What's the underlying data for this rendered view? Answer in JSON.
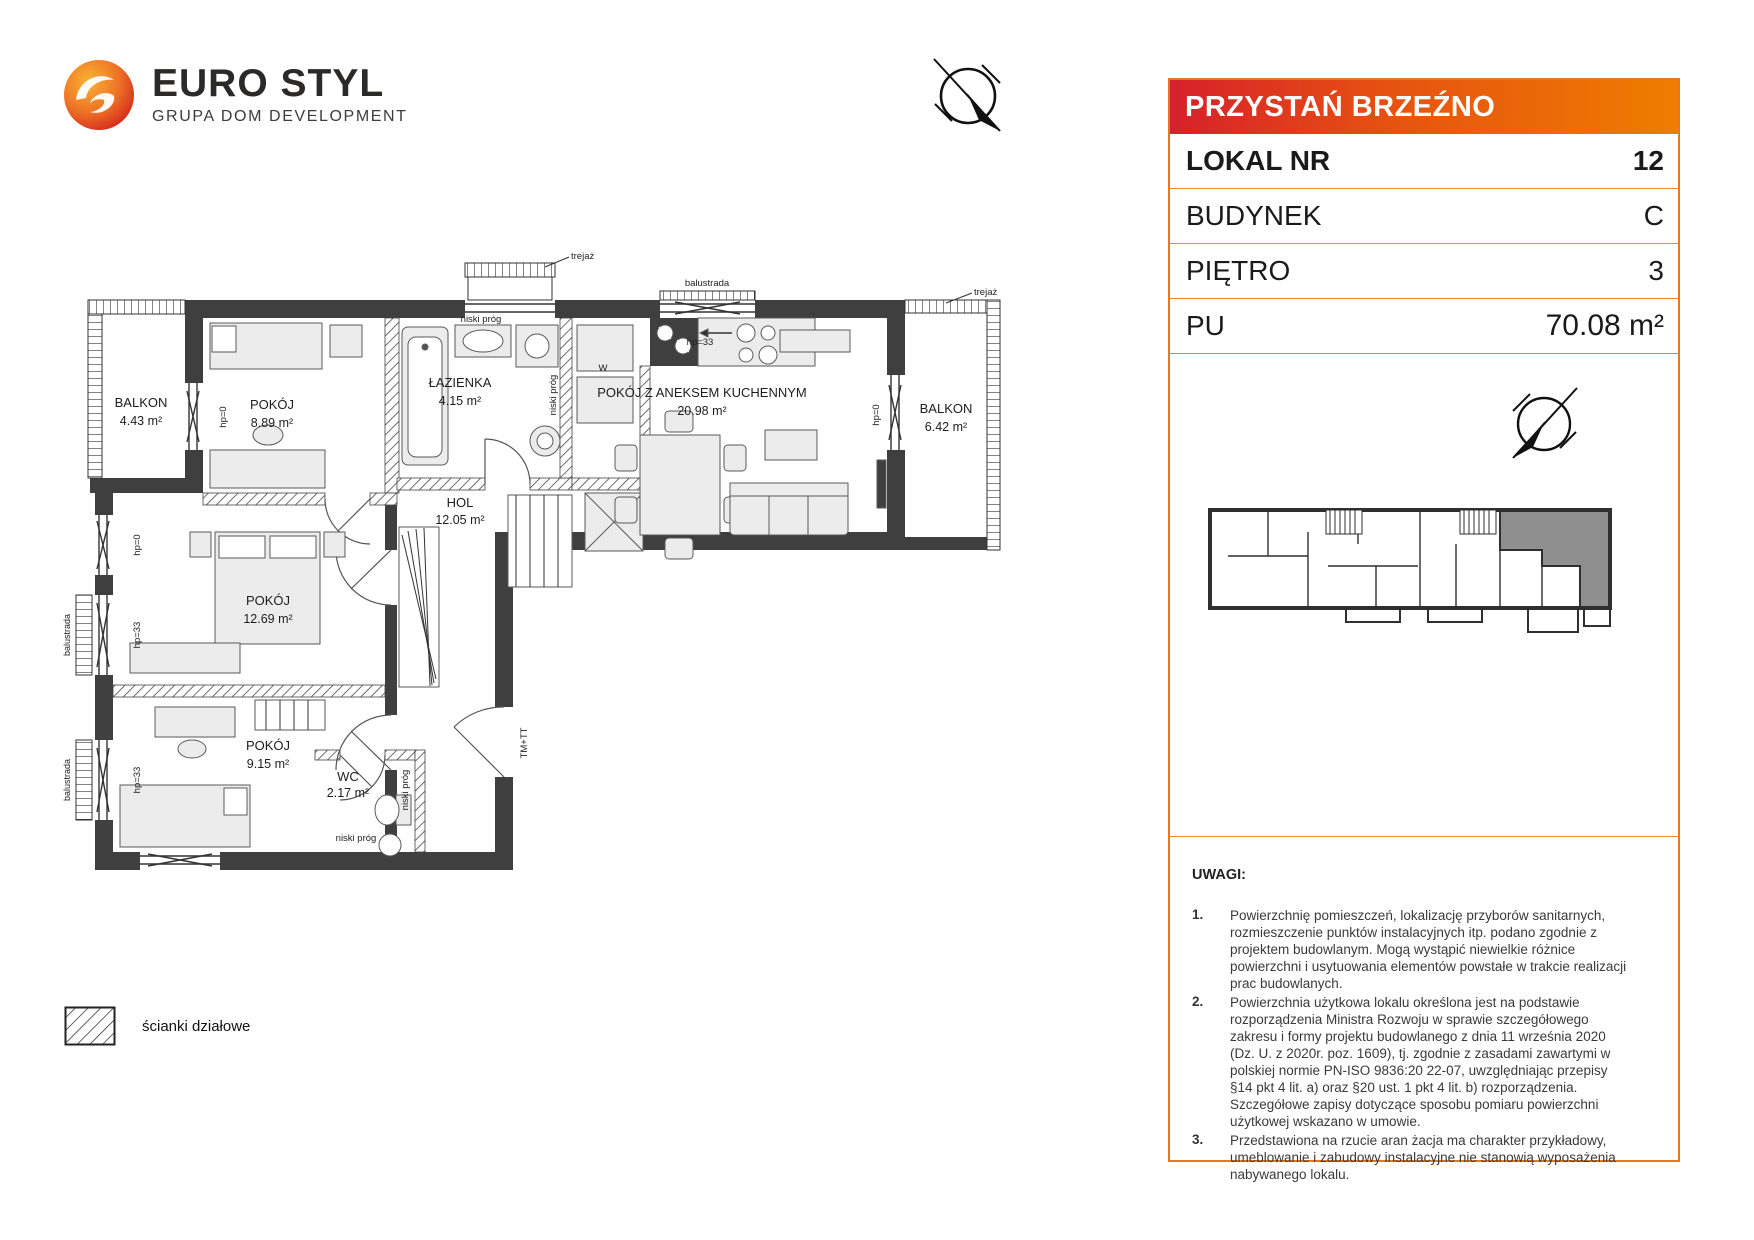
{
  "logo": {
    "name": "EURO STYL",
    "tagline": "GRUPA DOM DEVELOPMENT"
  },
  "panel": {
    "project_name": "PRZYSTAŃ BRZEŹNO",
    "rows": [
      {
        "label": "LOKAL NR",
        "value": "12"
      },
      {
        "label": "BUDYNEK",
        "value": "C"
      },
      {
        "label": "PIĘTRO",
        "value": "3"
      },
      {
        "label": "PU",
        "value": "70.08 m²"
      }
    ],
    "notes_title": "UWAGI:",
    "notes": [
      {
        "num": "1.",
        "text": "Powierzchnię pomieszczeń, lokalizację przyborów sanitarnych, rozmieszczenie punktów instalacyjnych itp. podano zgodnie z projektem budowlanym. Mogą wystąpić niewielkie różnice powierzchni i usytuowania elementów powstałe w trakcie realizacji prac budowlanych."
      },
      {
        "num": "2.",
        "text": "Powierzchnia użytkowa lokalu określona jest na podstawie rozporządzenia Ministra Rozwoju w sprawie szczegółowego zakresu i formy projektu budowlanego z dnia 11 września 2020 (Dz. U. z 2020r. poz. 1609), tj. zgodnie z zasadami zawartymi w polskiej normie PN-ISO 9836:20 22-07, uwzględniając przepisy §14 pkt 4 lit. a) oraz §20 ust. 1 pkt 4 lit. b) rozporządzenia. Szczegółowe zapisy dotyczące sposobu pomiaru powierzchni użytkowej wskazano w umowie."
      },
      {
        "num": "3.",
        "text": "Przedstawiona na rzucie aran żacja ma charakter przykładowy, umeblowanie i zabudowy instalacyjne nie stanowią wyposażenia nabywanego lokalu."
      }
    ]
  },
  "plan": {
    "rooms": [
      {
        "name": "BALKON",
        "area": "4.43 m²"
      },
      {
        "name": "POKÓJ",
        "area": "8.89 m²"
      },
      {
        "name": "ŁAZIENKA",
        "area": "4.15 m²"
      },
      {
        "name": "POKÓJ Z ANEKSEM KUCHENNYM",
        "area": "20.98 m²"
      },
      {
        "name": "BALKON",
        "area": "6.42 m²"
      },
      {
        "name": "HOL",
        "area": "12.05 m²"
      },
      {
        "name": "POKÓJ",
        "area": "12.69 m²"
      },
      {
        "name": "POKÓJ",
        "area": "9.15 m²"
      },
      {
        "name": "WC",
        "area": "2.17 m²"
      }
    ],
    "labels": {
      "trejaz": "trejaż",
      "balustrada": "balustrada",
      "hp0": "hp=0",
      "hp33": "hp=33",
      "niski_prog": "niski próg",
      "entry": "TM+TT",
      "washer": "W"
    }
  },
  "legend": {
    "label": "ścianki działowe"
  },
  "colors": {
    "accent": "#E8761B",
    "header_gradient_left": "#D7202B",
    "header_gradient_right": "#EF7D00",
    "wall": "#3F3F3F",
    "highlight_unit": "#8F8F8F"
  }
}
